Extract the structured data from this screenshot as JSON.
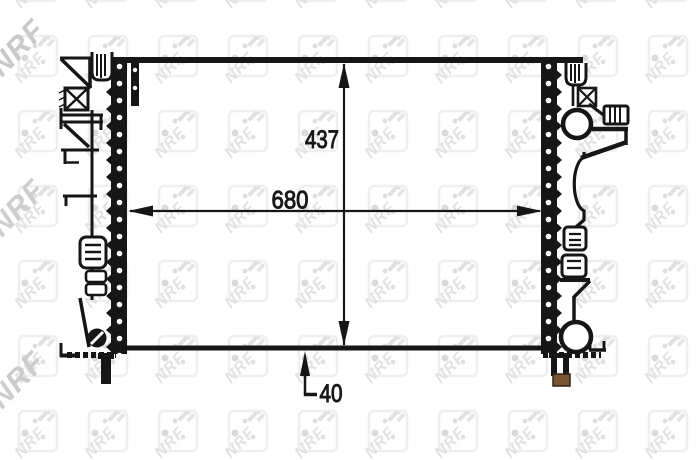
{
  "diagram": {
    "kind": "radiator technical outline drawing",
    "dimensions": {
      "width": "680",
      "height": "437",
      "depth": "40"
    }
  },
  "watermark": {
    "text": "NRF"
  },
  "colors": {
    "line": "#161616",
    "background": "#ffffff",
    "foot_rubber": "#7a5433",
    "watermark_tile_text": "#e2e2e2",
    "watermark_edge_text": "#c9c9c9"
  }
}
